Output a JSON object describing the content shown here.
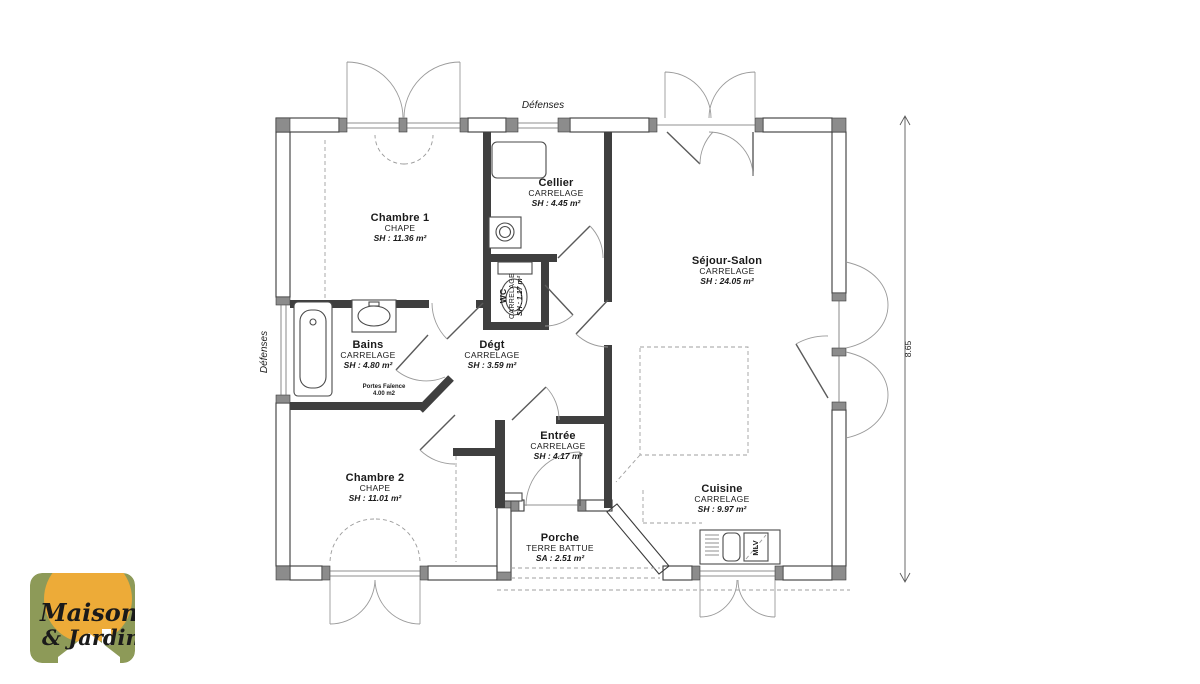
{
  "plan": {
    "labels": {
      "defenses_top": "Défenses",
      "defenses_left": "Défenses",
      "dimension_right": "8.65",
      "mlv": "MLV"
    },
    "rooms": {
      "chambre1": {
        "name": "Chambre 1",
        "material": "CHAPE",
        "area": "SH : 11.36 m²"
      },
      "cellier": {
        "name": "Cellier",
        "material": "CARRELAGE",
        "area": "SH : 4.45 m²"
      },
      "sejour": {
        "name": "Séjour-Salon",
        "material": "CARRELAGE",
        "area": "SH : 24.05 m²"
      },
      "bains": {
        "name": "Bains",
        "material": "CARRELAGE",
        "area": "SH : 4.80 m²",
        "note1": "Portes Faïence",
        "note2": "4.00 m2"
      },
      "wc": {
        "name": "WC",
        "material": "CARRELAGE",
        "area": "SH : 1.17 m²"
      },
      "degt": {
        "name": "Dégt",
        "material": "CARRELAGE",
        "area": "SH : 3.59 m²"
      },
      "chambre2": {
        "name": "Chambre 2",
        "material": "CHAPE",
        "area": "SH : 11.01 m²"
      },
      "entree": {
        "name": "Entrée",
        "material": "CARRELAGE",
        "area": "SH : 4.17 m²"
      },
      "cuisine": {
        "name": "Cuisine",
        "material": "CARRELAGE",
        "area": "SH : 9.97 m²"
      },
      "porche": {
        "name": "Porche",
        "material": "TERRE BATTUE",
        "area": "SA : 2.51 m²"
      }
    }
  },
  "logo": {
    "word1": "Maison",
    "word2": "& Jardin",
    "colors": {
      "background": "#8d9a58",
      "circle": "#edab38",
      "text": "#5a2414",
      "house": "#ffffff"
    }
  }
}
